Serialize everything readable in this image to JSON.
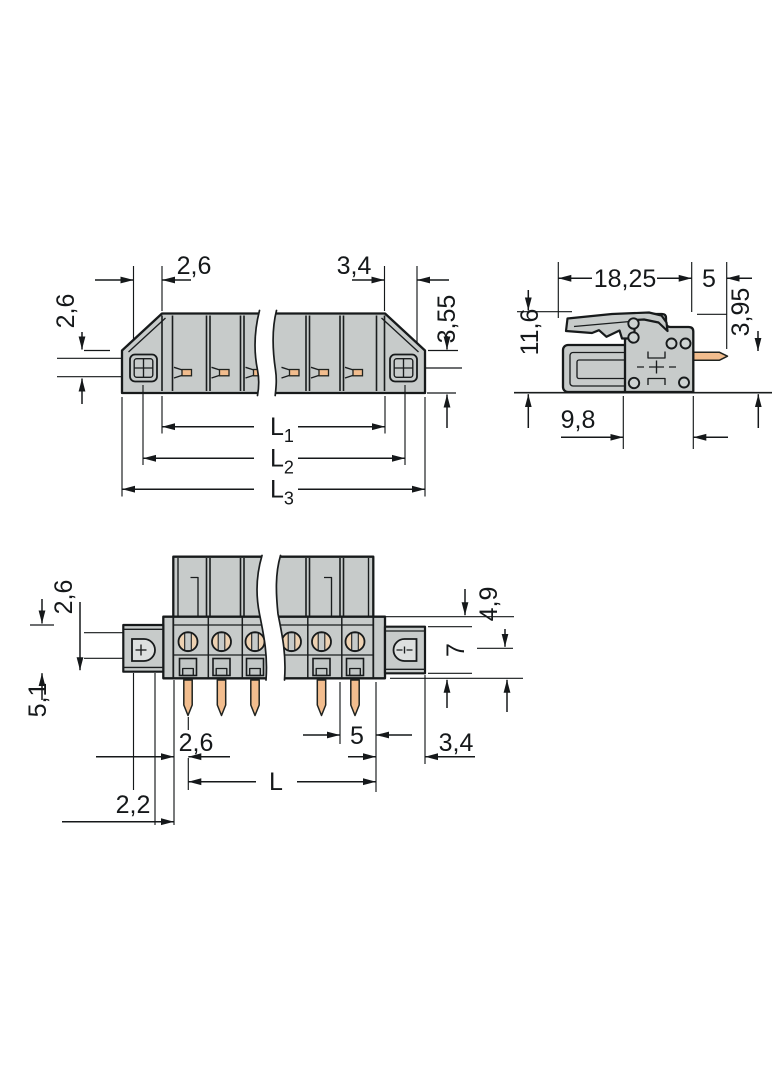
{
  "drawing_type": "connector-dimension-drawing",
  "colors": {
    "background": "#ffffff",
    "body_gray": "#c7cbca",
    "panel_gray": "#c2c7c6",
    "pin_orange": "#f2bd8e",
    "contact_tan": "#eed2b2",
    "outline_dark": "#171a1b",
    "dimension_dark": "#15181a"
  },
  "views": {
    "front": {
      "dims": {
        "top_left": "2,6",
        "top_right": "3,4",
        "right_side": "3,55",
        "left_side": "2,6",
        "l1": {
          "base": "L",
          "sub": "1"
        },
        "l2": {
          "base": "L",
          "sub": "2"
        },
        "l3": {
          "base": "L",
          "sub": "3"
        }
      }
    },
    "side": {
      "dims": {
        "total_width": "18,25",
        "pin_length": "5",
        "total_height": "11,6",
        "pin_height": "3,95",
        "mount_depth": "9,8"
      }
    },
    "bottom": {
      "dims": {
        "upper_left": "2,6",
        "lower_left": "5,1",
        "upper_right": "4,9",
        "flange_right": "7",
        "pin_offset": "2,6",
        "pin_pitch": "5",
        "right_offset": "3,4",
        "length": "L",
        "edge_offset": "2,2"
      }
    }
  }
}
